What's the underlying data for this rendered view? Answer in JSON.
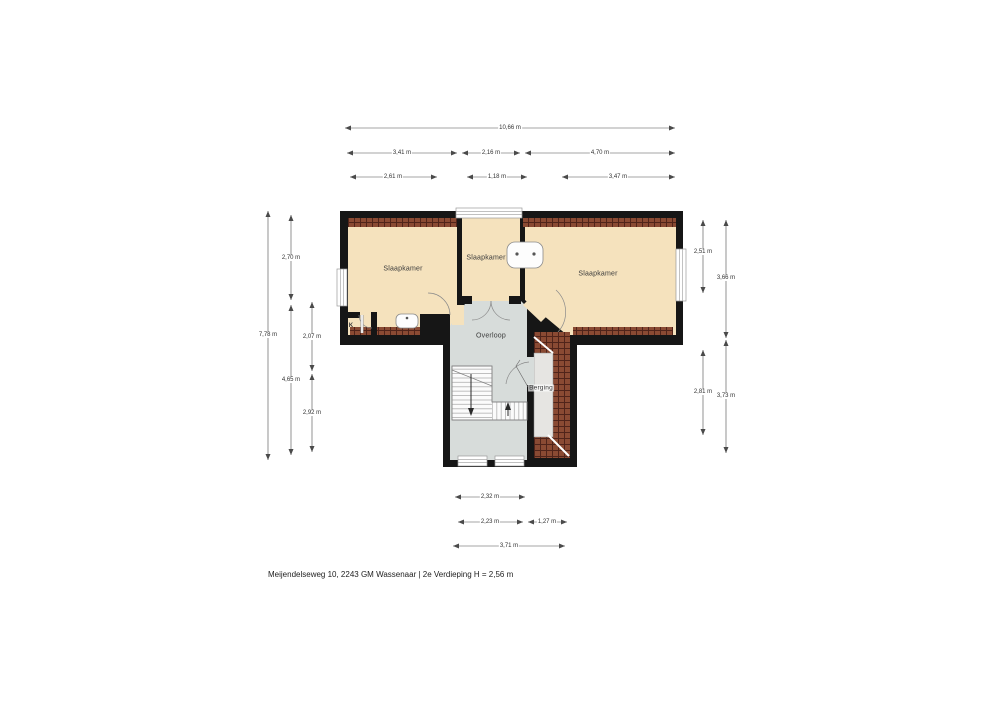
{
  "meta": {
    "caption": "Meijendelseweg 10, 2243 GM Wassenaar | 2e Verdieping H = 2,56 m"
  },
  "rooms": {
    "bedroom_left": "Slaapkamer",
    "bedroom_middle": "Slaapkamer",
    "bedroom_right": "Slaapkamer",
    "landing": "Overloop",
    "storage": "Berging",
    "closet": "K"
  },
  "dimensions": {
    "top": {
      "total": "10,66 m",
      "row2": [
        "3,41 m",
        "2,16 m",
        "4,70 m"
      ],
      "row3": [
        "2,61 m",
        "1,18 m",
        "3,47 m"
      ]
    },
    "left": {
      "total": "7,78 m",
      "mid": [
        "2,70 m",
        "4,65 m"
      ],
      "inner": [
        "2,07 m",
        "2,92 m"
      ]
    },
    "right": {
      "inner": [
        "2,51 m",
        "2,81 m"
      ],
      "outer": [
        "3,66 m",
        "3,73 m"
      ]
    },
    "bottom": {
      "row1": "2,32 m",
      "row2": [
        "2,23 m",
        "1,27 m"
      ],
      "row3": "3,71 m"
    }
  },
  "colors": {
    "wall": "#161616",
    "room-fill": "#f5e2bd",
    "hall-fill": "#d7dcda",
    "roof-hatch": "#8a4a33",
    "hatch-line": "#50241a",
    "storage-fill": "#e6e5e2",
    "dim-line": "#4a4a4a",
    "text": "#333333"
  }
}
